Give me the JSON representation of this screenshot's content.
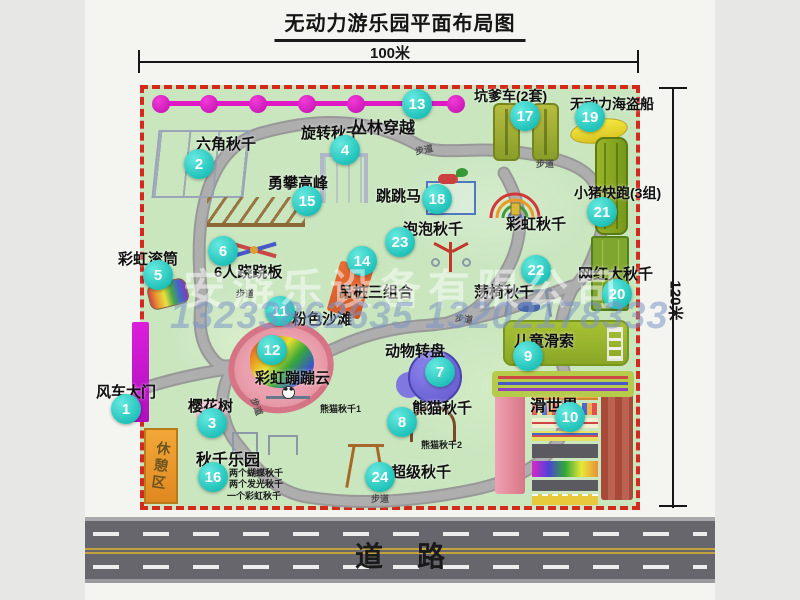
{
  "title": "无动力游乐园平面布局图",
  "dimensions": {
    "top": "100米",
    "right": "120米"
  },
  "road": {
    "label": "道路"
  },
  "watermark": {
    "company": "安游乐设备有限公司",
    "phone": "13233862635 13202178333"
  },
  "colors": {
    "border_red": "#d42a1e",
    "map_green": "#c9e6bf",
    "path_gray": "#a6a6a6",
    "marker_teal": "#1cc0b8",
    "zipline_magenta": "#df17c4",
    "road_asphalt": "#66666c",
    "rest_area_orange": "#efa232"
  },
  "park": {
    "rest_area_label": "休憩区",
    "trail_label": "步道",
    "trail_positions": [
      {
        "x": 415,
        "y": 143,
        "r": -12
      },
      {
        "x": 536,
        "y": 157,
        "r": 0
      },
      {
        "x": 236,
        "y": 287,
        "r": 0
      },
      {
        "x": 455,
        "y": 312,
        "r": 8
      },
      {
        "x": 371,
        "y": 492,
        "r": 0
      },
      {
        "x": 248,
        "y": 400,
        "r": 70
      }
    ],
    "attractions": [
      {
        "n": "1",
        "name": "风车大门",
        "cx": 126,
        "cy": 409,
        "lx": 96,
        "ly": 381
      },
      {
        "n": "2",
        "name": "六角秋千",
        "cx": 199,
        "cy": 164,
        "lx": 196,
        "ly": 133
      },
      {
        "n": "3",
        "name": "樱花树",
        "cx": 212,
        "cy": 423,
        "lx": 188,
        "ly": 395
      },
      {
        "n": "4",
        "name": "旋转秋千",
        "cx": 345,
        "cy": 150,
        "lx": 301,
        "ly": 122
      },
      {
        "n": "5",
        "name": "彩虹滚筒",
        "cx": 158,
        "cy": 275,
        "lx": 118,
        "ly": 248
      },
      {
        "n": "6",
        "name": "6人跷跷板",
        "cx": 223,
        "cy": 251,
        "lx": 214,
        "ly": 261
      },
      {
        "n": "7",
        "name": "动物转盘",
        "cx": 440,
        "cy": 372,
        "lx": 385,
        "ly": 340
      },
      {
        "n": "8",
        "name": "熊猫秋千",
        "cx": 402,
        "cy": 422,
        "lx": 412,
        "ly": 397
      },
      {
        "n": "9",
        "name": "儿童滑索",
        "cx": 528,
        "cy": 356,
        "lx": 514,
        "ly": 330
      },
      {
        "n": "10",
        "name": "滑世界",
        "cx": 570,
        "cy": 417,
        "lx": 530,
        "ly": 392,
        "fs": 16
      },
      {
        "n": "11",
        "name": "粉色沙滩",
        "cx": 280,
        "cy": 311,
        "lx": 292,
        "ly": 308
      },
      {
        "n": "12",
        "name": "彩虹蹦蹦云",
        "cx": 272,
        "cy": 350,
        "lx": 255,
        "ly": 367
      },
      {
        "n": "13",
        "name": "丛林穿越",
        "cx": 417,
        "cy": 104,
        "lx": 351,
        "ly": 114,
        "fs": 16
      },
      {
        "n": "14",
        "name": "吊桩三组合",
        "cx": 362,
        "cy": 261,
        "lx": 338,
        "ly": 281
      },
      {
        "n": "15",
        "name": "勇攀高峰",
        "cx": 307,
        "cy": 201,
        "lx": 268,
        "ly": 172
      },
      {
        "n": "16",
        "name": "秋千乐园",
        "cx": 213,
        "cy": 477,
        "lx": 196,
        "ly": 446,
        "fs": 16
      },
      {
        "n": "17",
        "name": "坑爹车(2套)",
        "cx": 525,
        "cy": 116,
        "lx": 474,
        "ly": 86,
        "fs": 14
      },
      {
        "n": "18",
        "name": "跳跳马",
        "cx": 437,
        "cy": 199,
        "lx": 376,
        "ly": 185
      },
      {
        "n": "19",
        "name": "无动力海盗船",
        "cx": 590,
        "cy": 117,
        "lx": 570,
        "ly": 94,
        "fs": 14
      },
      {
        "n": "20",
        "name": "网红大秋千",
        "cx": 617,
        "cy": 294,
        "lx": 578,
        "ly": 263
      },
      {
        "n": "21",
        "name": "小猪快跑(3组)",
        "cx": 602,
        "cy": 212,
        "lx": 574,
        "ly": 183,
        "fs": 14
      },
      {
        "n": "22",
        "name": "荡椅秋千",
        "cx": 536,
        "cy": 270,
        "lx": 474,
        "ly": 281
      },
      {
        "n": "23",
        "name": "泡泡秋千",
        "cx": 400,
        "cy": 242,
        "lx": 403,
        "ly": 218
      },
      {
        "n": "24",
        "name": "超级秋千",
        "cx": 380,
        "cy": 477,
        "lx": 391,
        "ly": 461
      },
      {
        "n": "",
        "name": "彩虹秋千",
        "cx": 0,
        "cy": 0,
        "lx": 506,
        "ly": 213
      }
    ],
    "notes": [
      {
        "text": "熊猫秋千1",
        "x": 320,
        "y": 402
      },
      {
        "text": "熊猫秋千2",
        "x": 421,
        "y": 438
      },
      {
        "text": "两个蝴蝶秋千",
        "x": 229,
        "y": 466
      },
      {
        "text": "两个发光秋千",
        "x": 229,
        "y": 477
      },
      {
        "text": "一个彩虹秋千",
        "x": 227,
        "y": 489
      }
    ]
  }
}
